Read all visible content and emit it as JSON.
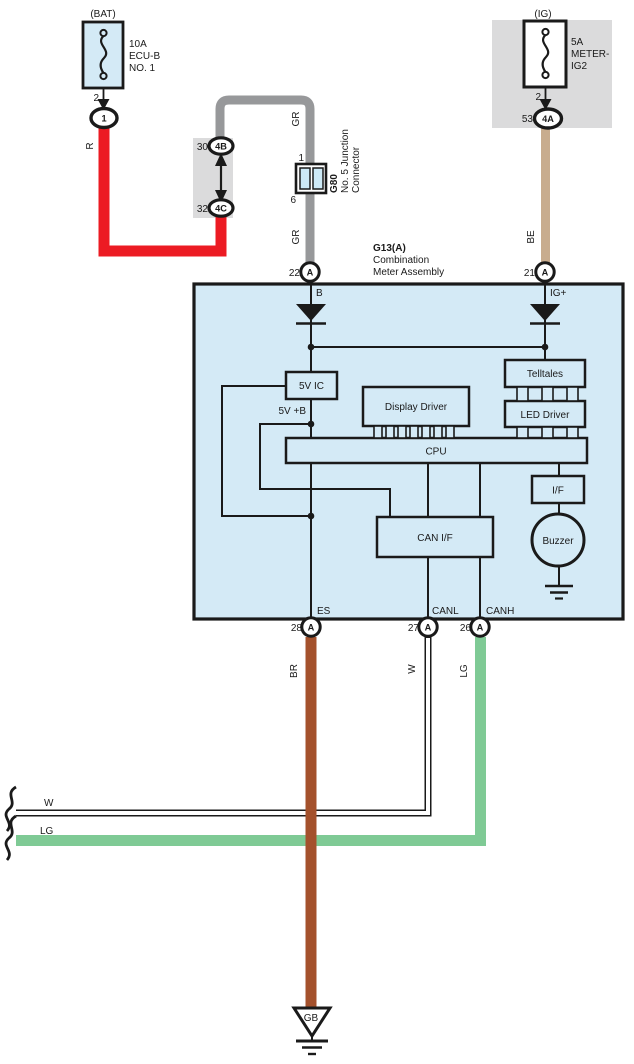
{
  "colors": {
    "panel_blue": "#D4EAF6",
    "cell_blue": "#CDE9F6",
    "shade_gray": "#DBDBDC",
    "wire_red": "#EC1B23",
    "wire_gray": "#97989A",
    "wire_beige": "#C8AC8E",
    "wire_brown": "#A4512C",
    "wire_green": "#7FCA95",
    "line_black": "#1A1A1A"
  },
  "bat": {
    "header": "(BAT)",
    "fuse_lines": [
      "10A",
      "ECU-B",
      "NO. 1"
    ],
    "pin": "2",
    "oval": "1",
    "wire_code": "R"
  },
  "ig": {
    "header": "(IG)",
    "fuse_lines": [
      "5A",
      "METER-",
      "IG2"
    ],
    "pin": "2",
    "pin53": "53",
    "oval": "4A",
    "wire_code": "BE"
  },
  "junction_block": {
    "pin_top": "30",
    "oval_top": "4B",
    "pin_bottom": "32",
    "oval_bottom": "4C"
  },
  "g80": {
    "wire_code_top": "GR",
    "pin_top": "1",
    "code": "G80",
    "desc1": "No. 5 Junction",
    "desc2": "Connector",
    "pin_bottom": "6",
    "wire_code_bottom": "GR"
  },
  "meter": {
    "code": "G13(A)",
    "name1": "Combination",
    "name2": "Meter Assembly",
    "pin22": "22",
    "pin21": "21",
    "pin_a": "A",
    "net_b": "B",
    "net_igp": "IG+",
    "c_5vic": "5V IC",
    "net_5vb": "5V +B",
    "c_display": "Display Driver",
    "c_telltales": "Telltales",
    "c_led": "LED Driver",
    "c_cpu": "CPU",
    "c_canif": "CAN I/F",
    "c_if": "I/F",
    "c_buzzer": "Buzzer",
    "net_es": "ES",
    "net_canl": "CANL",
    "net_canh": "CANH",
    "pin28": "28",
    "pin27": "27",
    "pin26": "26"
  },
  "wires": {
    "br": "BR",
    "w": "W",
    "lg": "LG"
  },
  "left_stubs": {
    "w": "W",
    "lg": "LG"
  },
  "ground": {
    "label": "GB"
  }
}
